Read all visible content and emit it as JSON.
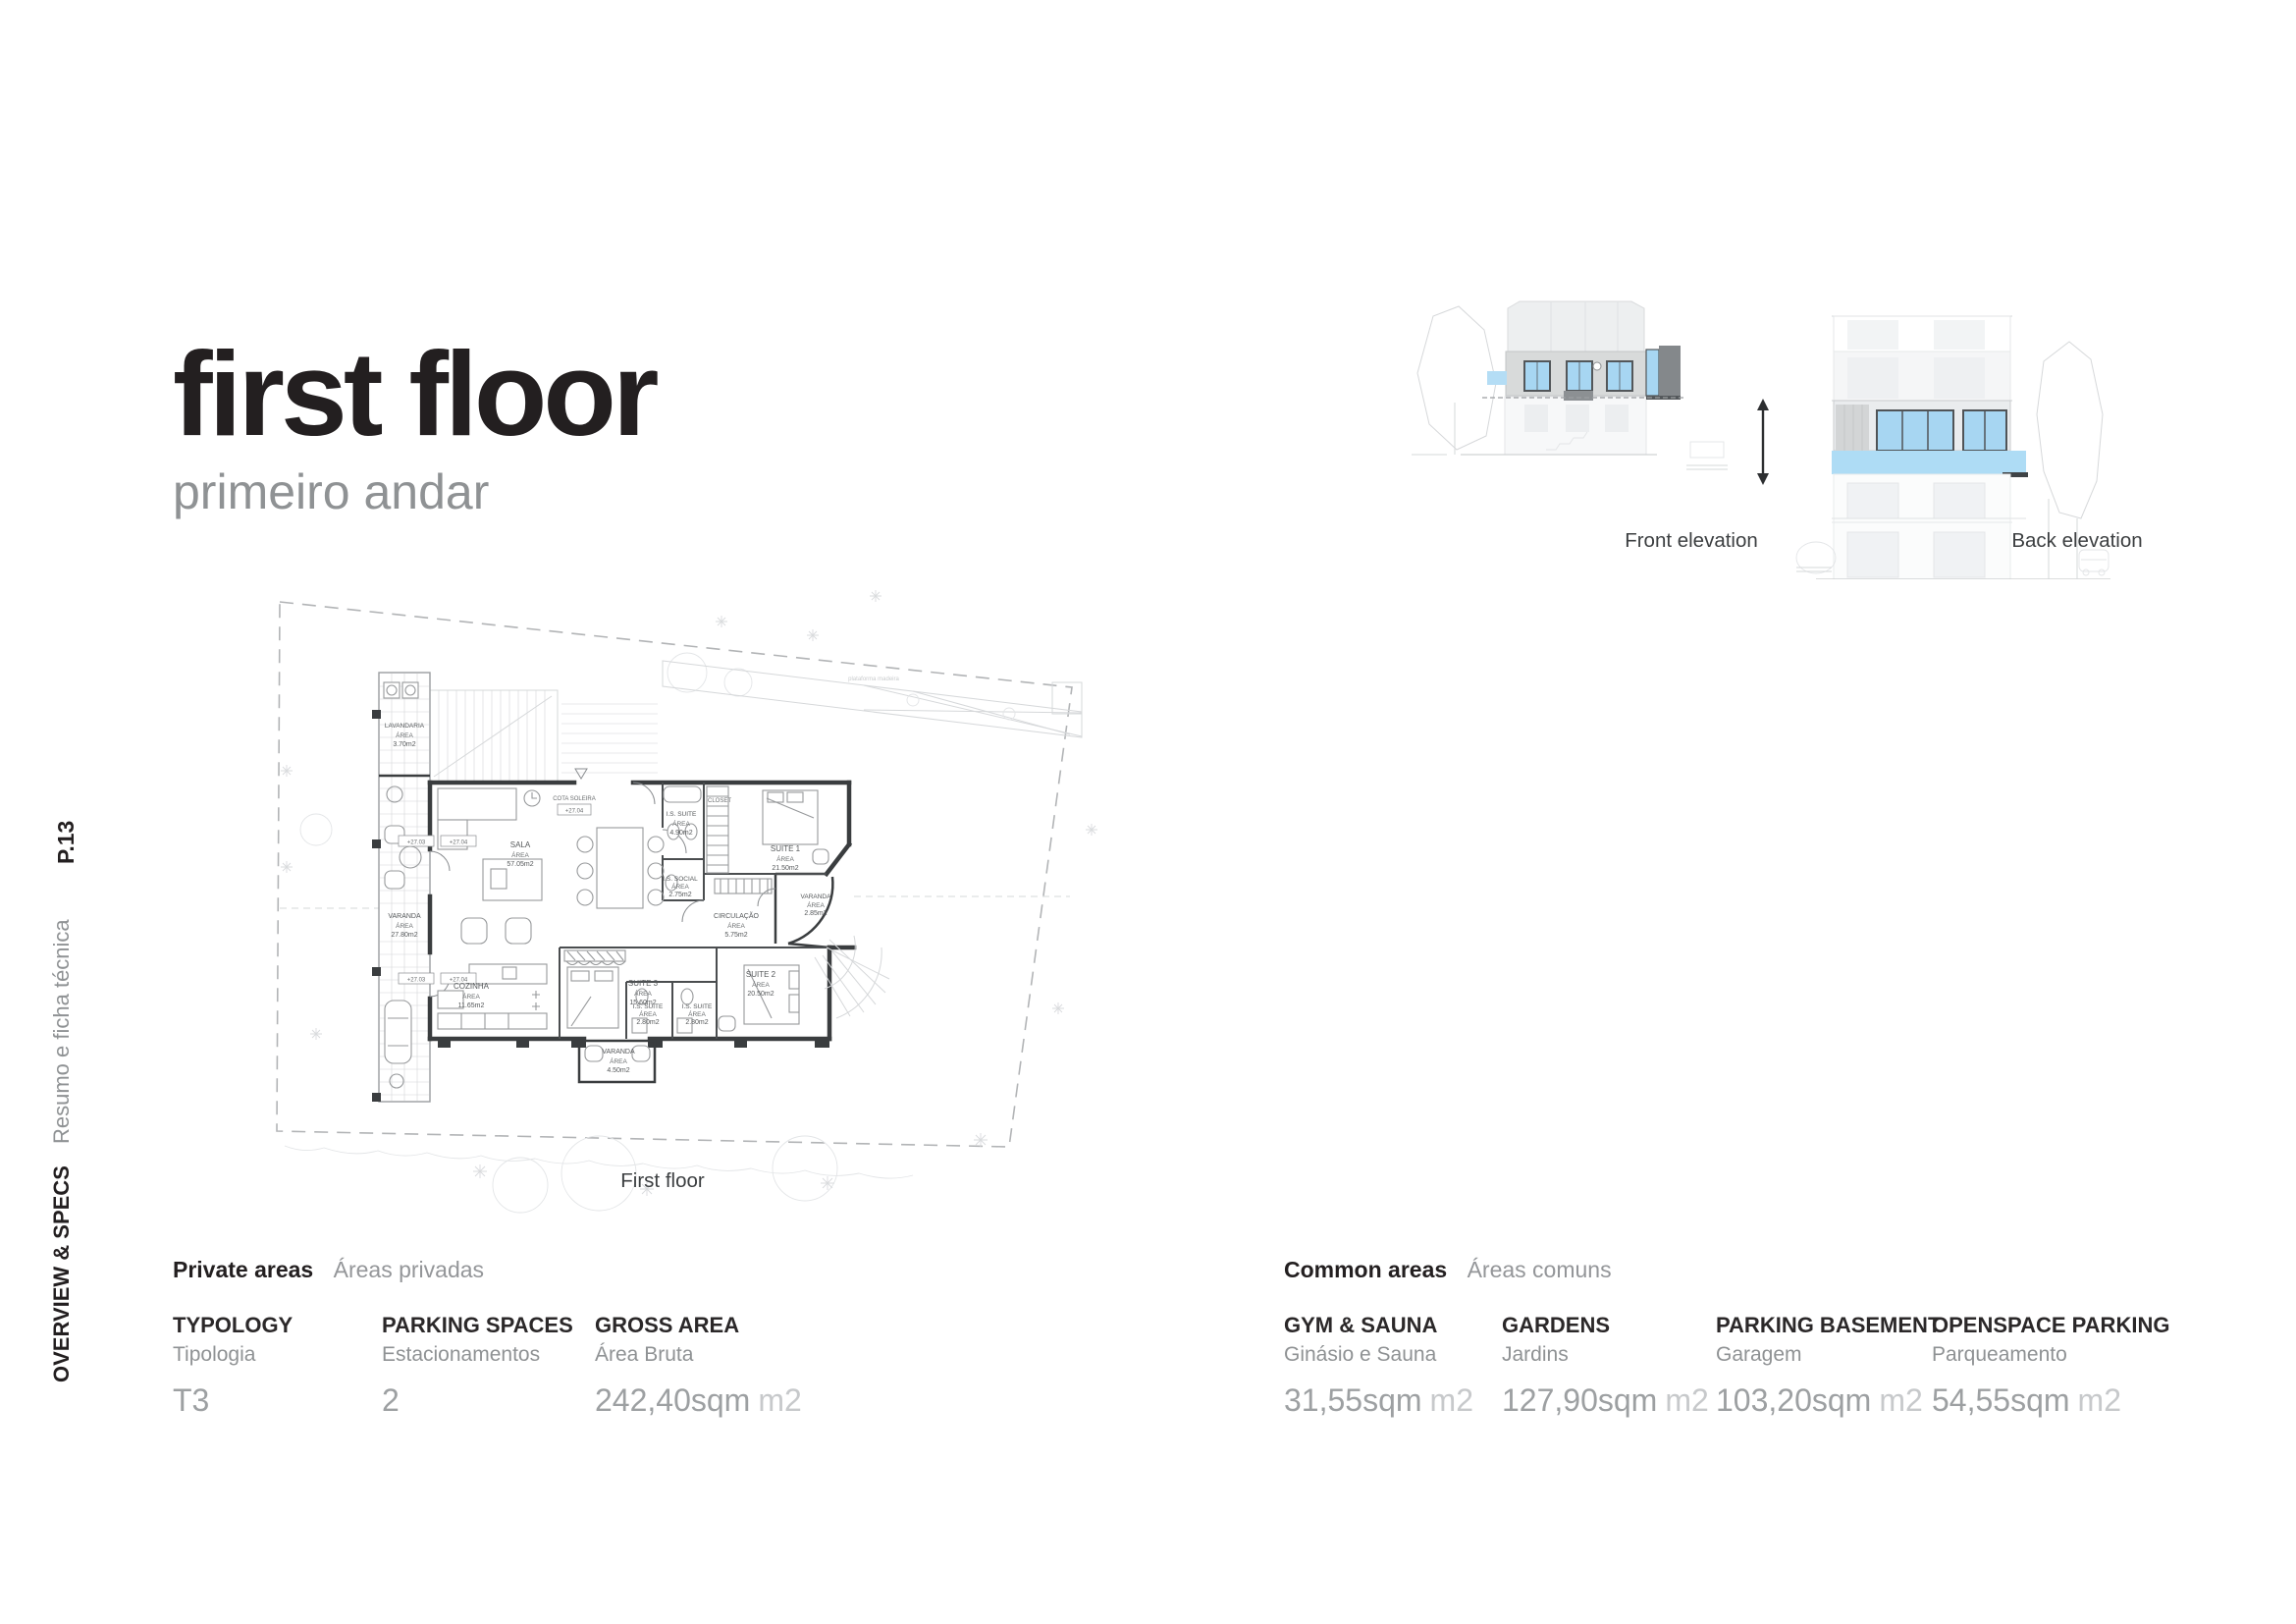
{
  "page": {
    "title": "first floor",
    "subtitle": "primeiro andar",
    "page_number": "P.13",
    "section_label": "OVERVIEW & SPECS",
    "section_sublabel": "Resumo e ficha técnica"
  },
  "plan": {
    "caption": "First floor",
    "area_word": "ÁREA",
    "cota_label": "COTA SOLEIRA",
    "cota_value": "+27.04",
    "closet": "CLOSET",
    "platform_note": "plataforma madeira",
    "level_markers": [
      "+27.03",
      "+27.04",
      "+27.03",
      "+27.04"
    ],
    "rooms": [
      {
        "name": "LAVANDARIA",
        "area": "3.70m2"
      },
      {
        "name": "VARANDA",
        "area": "27.80m2"
      },
      {
        "name": "SALA",
        "area": "57.05m2"
      },
      {
        "name": "COZINHA",
        "area": "11.65m2"
      },
      {
        "name": "SUITE 3",
        "area": "15.60m2"
      },
      {
        "name": "I.S. SUITE",
        "area": "2.80m2"
      },
      {
        "name": "I.S. SUITE",
        "area": "2.80m2"
      },
      {
        "name": "SUITE 2",
        "area": "20.50m2"
      },
      {
        "name": "VARANDA",
        "area": "4.50m2"
      },
      {
        "name": "CIRCULAÇÃO",
        "area": "5.75m2"
      },
      {
        "name": "I.S. SOCIAL",
        "area": "2.75m2"
      },
      {
        "name": "I.S. SUITE",
        "area": "4.90m2"
      },
      {
        "name": "SUITE 1",
        "area": "21.50m2"
      },
      {
        "name": "VARANDA",
        "area": "2.85m2"
      }
    ]
  },
  "elevations": {
    "front_caption": "Front elevation",
    "back_caption": "Back elevation"
  },
  "specs": {
    "private": {
      "title": "Private areas",
      "subtitle": "Áreas privadas",
      "items": [
        {
          "label": "TYPOLOGY",
          "sublabel": "Tipologia",
          "value": "T3",
          "unit": ""
        },
        {
          "label": "PARKING SPACES",
          "sublabel": "Estacionamentos",
          "value": "2",
          "unit": ""
        },
        {
          "label": "GROSS AREA",
          "sublabel": "Área Bruta",
          "value": "242,40sqm",
          "unit": "m2"
        }
      ]
    },
    "common": {
      "title": "Common areas",
      "subtitle": "Áreas comuns",
      "items": [
        {
          "label": "GYM & SAUNA",
          "sublabel": "Ginásio e Sauna",
          "value": "31,55sqm",
          "unit": "m2"
        },
        {
          "label": "GARDENS",
          "sublabel": "Jardins",
          "value": "127,90sqm",
          "unit": "m2"
        },
        {
          "label": "PARKING BASEMENT",
          "sublabel": "Garagem",
          "value": "103,20sqm",
          "unit": "m2"
        },
        {
          "label": "OPENSPACE PARKING",
          "sublabel": "Parqueamento",
          "value": "54,55sqm",
          "unit": "m2"
        }
      ]
    }
  },
  "colors": {
    "accent_blue": "#a7d6f2",
    "band_blue": "#aedcf5",
    "dark_gray_block": "#84888b",
    "text_dark": "#231f20",
    "text_gray": "#8f9294",
    "value_gray": "#9da0a2",
    "unit_gray": "#c7c9cb"
  }
}
